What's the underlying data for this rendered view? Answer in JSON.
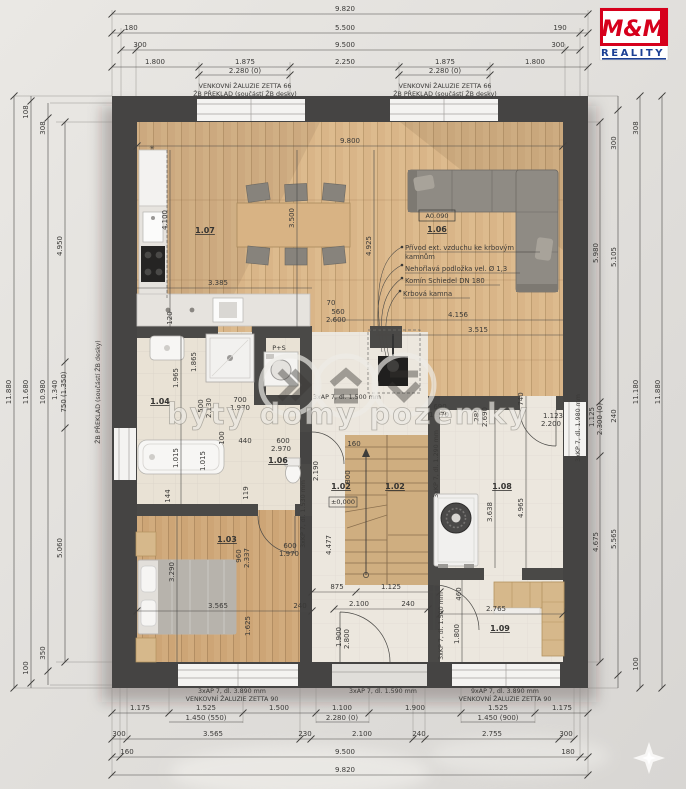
{
  "logo": {
    "mm": "M&M",
    "reality": "REALITY"
  },
  "watermark": {
    "text": "byty domy pozemky"
  },
  "rooms": {
    "r07": "1.07",
    "r06a": "1.06",
    "r04": "1.04",
    "r06b": "1.06",
    "r02a": "1.02",
    "r02b": "1.02",
    "r03": "1.03",
    "r08": "1.08",
    "r09": "1.09"
  },
  "notes": {
    "zaluzie66": "VENKOVNÍ ŽALUZIE ZETTA 66",
    "preklad": "ŽB PŘEKLAD (součástí ŽB desky)",
    "zaluzie90": "VENKOVNÍ ŽALUZIE ZETTA 90",
    "ap389": "3xAP 7, dl. 3.890 mm",
    "ap159": "3xAP 7, dl. 1.590 mm",
    "ap9_389": "9xAP 7, dl. 3.890 mm",
    "ap150": "3xAP 7, dl. 1.500 mm",
    "kp198": "3xKP 7, dl. 1.980 mm",
    "kp129": "3xKP 7, dl. 1.290 mm",
    "kp153": "3xKP 7, dl. 1.530 mm",
    "kp150": "3xKP 7, dl. 1.500 mm",
    "privod1": "Přívod ext. vzduchu ke krbovým",
    "privod2": "kamnům",
    "podlozka": "Nehořlavá podložka vel. Ø 1,3",
    "komin": "Komín Schiedel DN 180",
    "krb": "Krbová kamna",
    "ps": "P+S",
    "aref": "A0.090",
    "elev": "±0,000",
    "snow": "✳"
  },
  "dims": {
    "top": [
      "9.820",
      "180",
      "5.500",
      "190",
      "300",
      "9.500",
      "300",
      "1.800",
      "1.875",
      "2.250",
      "1.875",
      "1.800",
      "2.280 (0)",
      "2.280 (0)"
    ],
    "left": [
      "11.880",
      "108",
      "11.680",
      "100",
      "308",
      "10.980",
      "350",
      "4.950",
      "1.340",
      "750 (1.350)",
      "5.060"
    ],
    "right": [
      "5.980",
      "1.125",
      "2.300 (0)",
      "4.675",
      "300",
      "5.105",
      "240",
      "5.565",
      "300",
      "308",
      "11.180",
      "100",
      "11.880"
    ],
    "bottom": [
      "1.175",
      "1.525",
      "1.500",
      "1.100",
      "1.900",
      "1.525",
      "1.175",
      "1.450 (550)",
      "2.280 (0)",
      "1.450 (900)",
      "300",
      "3.565",
      "230",
      "2.100",
      "240",
      "2.755",
      "300",
      "160",
      "9.500",
      "180",
      "9.820"
    ],
    "inner": [
      "9.800",
      "4.100",
      "3.500",
      "3.385",
      "120",
      "70",
      "560",
      "2.600",
      "4.156",
      "3.515",
      "4.925",
      "1.965",
      "1.865",
      "500",
      "2.130",
      "700",
      "1.970",
      "100",
      "1.015",
      "1.015",
      "440",
      "600",
      "2.970",
      "144",
      "119",
      "2.190",
      "160",
      "800",
      "875",
      "1.125",
      "3.565",
      "240",
      "2.100",
      "240",
      "1.900",
      "2.800",
      "3.290",
      "960",
      "2.337",
      "600",
      "1.970",
      "1.625",
      "4.477",
      "690",
      "1.970",
      "285",
      "2.690",
      "740",
      "1.123",
      "2.200",
      "3.638",
      "4.965",
      "2.765",
      "1.800",
      "460"
    ]
  }
}
